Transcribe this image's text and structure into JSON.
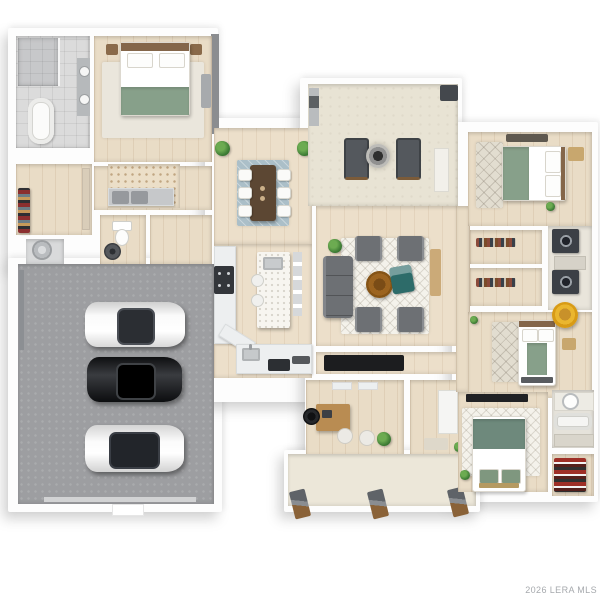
{
  "watermark": "2026 LERA MLS",
  "plan_type": "3D top-down residential floor plan rendering",
  "rooms": [
    {
      "name": "Master Bathroom"
    },
    {
      "name": "Master Bedroom"
    },
    {
      "name": "Hallway"
    },
    {
      "name": "Laundry Room"
    },
    {
      "name": "Walk-in Closet"
    },
    {
      "name": "Utility"
    },
    {
      "name": "Powder Room"
    },
    {
      "name": "Mudroom Hall"
    },
    {
      "name": "3-Car Garage"
    },
    {
      "name": "Dining Room"
    },
    {
      "name": "Kitchen"
    },
    {
      "name": "Covered Patio"
    },
    {
      "name": "Living Room"
    },
    {
      "name": "Hall"
    },
    {
      "name": "Office"
    },
    {
      "name": "Entry Foyer"
    },
    {
      "name": "Front Porch"
    },
    {
      "name": "East Hall"
    },
    {
      "name": "Bedroom 2"
    },
    {
      "name": "Closet"
    },
    {
      "name": "Closet"
    },
    {
      "name": "Laundry Closet"
    },
    {
      "name": "Bedroom 3"
    },
    {
      "name": "Bedroom 4"
    },
    {
      "name": "Bathroom"
    },
    {
      "name": "Closet"
    }
  ],
  "vehicles": [
    {
      "name": "white sedan"
    },
    {
      "name": "black sedan"
    },
    {
      "name": "white sports coupe"
    }
  ],
  "furniture_summary": {
    "beds": 4,
    "bathtubs": 2,
    "showers": 1,
    "washer_dryer_sets": 2,
    "fire_pit": 1,
    "dining_seats": 6,
    "porch_posts": 3
  },
  "colors": {
    "wall": "#fdfdfd",
    "wood_floor": "#e9dcc6",
    "garage_floor": "#9d9ea1",
    "patio_floor": "#e8e3d4",
    "bedding_green": "#87a08a",
    "dining_rug_blue": "#abbfc8",
    "teal_accent": "#2d6b69",
    "papasan_yellow": "#e0a71e",
    "coffee_table_brown": "#9c6420",
    "watermark_gray": "#a6a9ad"
  }
}
